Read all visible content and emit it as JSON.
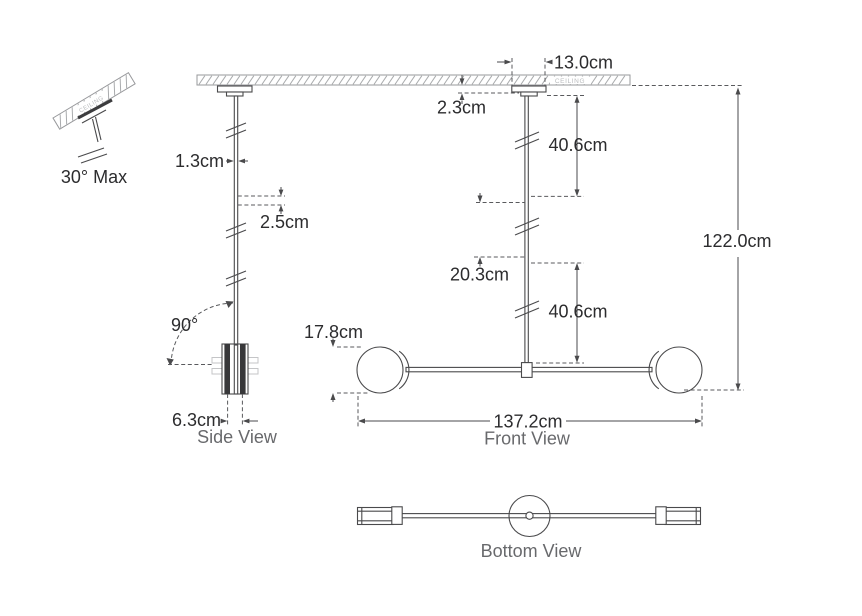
{
  "tilt_detail": {
    "ceiling_label": "CEILING",
    "max_angle": "30° Max"
  },
  "side_view": {
    "label": "Side View",
    "rod_diameter": "1.3cm",
    "joint_length": "2.5cm",
    "swivel_angle": "90°",
    "disc_width": "6.3cm"
  },
  "front_view": {
    "label": "Front View",
    "ceiling_label": "CEILING",
    "canopy_width": "13.0cm",
    "canopy_height": "2.3cm",
    "upper_rod": "40.6cm",
    "middle_rod": "20.3cm",
    "lower_rod": "40.6cm",
    "overall_height": "122.0cm",
    "shade_diameter": "17.8cm",
    "overall_width": "137.2cm"
  },
  "bottom_view": {
    "label": "Bottom View"
  },
  "colors": {
    "line": "#4a4a4c",
    "dimension_text": "#2c2c2e",
    "view_label_text": "#68696c",
    "ceiling_text": "#b9bbbd",
    "hatch": "#a9abad"
  }
}
